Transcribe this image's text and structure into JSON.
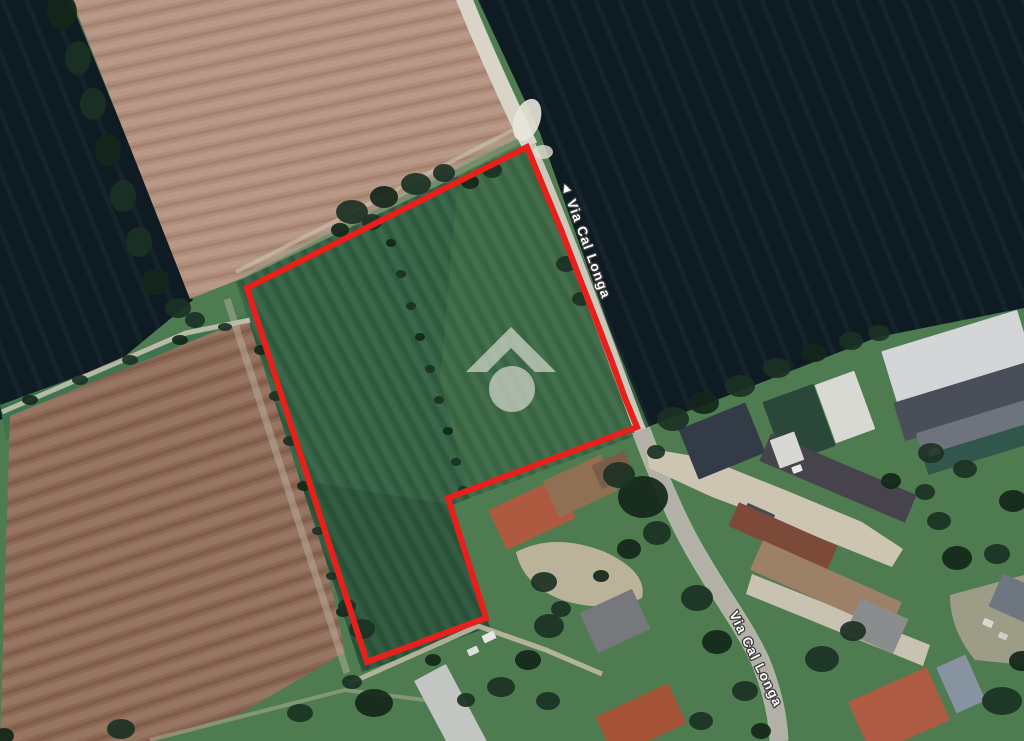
{
  "map": {
    "type": "satellite-view",
    "street_labels": [
      {
        "street": "Via Cal Longa",
        "display": "◄ Via Cal Longa",
        "rotation_deg": 70,
        "transform": "translate(560,183) rotate(70)"
      },
      {
        "street": "Via Cal Longa",
        "display": "Via Cal Longa",
        "rotation_deg": 64,
        "transform": "translate(729,614) rotate(64)"
      }
    ],
    "parcel_boundary": {
      "color": "#e8201c",
      "stroke_width": 6,
      "points": "527,147 543,186 562,232 578,274 596,320 612,362 625,398 637,427 448,498 486,618 367,662 247,288"
    },
    "watermark": {
      "name": "listing-portal-logo",
      "shape": "roof-chevron-over-circle",
      "color": "rgba(219,221,212,0.68)",
      "roof_points": "466,372 511,327 556,372 535,372 511,348 487,372",
      "circle": {
        "cx": 512,
        "cy": 389,
        "r": 23
      }
    },
    "palette": {
      "grass": "#4e7b50",
      "field_dark": "#0e1b22",
      "field_brown_top": "#b08d7a",
      "field_brown_bottom": "#8d6955",
      "parcel_green": "#315f41",
      "green_strip": "#3e7551",
      "road_gravel": "#d9d4c7",
      "road_asphalt": "#b3b0a8",
      "yard_concrete": "#cdc4b2",
      "dirt": "#c6b9a2",
      "label_fill": "#ffffff",
      "label_halo": "#3c3c3c"
    },
    "scene": {
      "tree_colors": [
        "#1b3124",
        "#142619"
      ],
      "trees": [
        [
          62,
          12,
          15,
          18
        ],
        [
          78,
          58,
          13,
          17
        ],
        [
          93,
          104,
          13,
          16
        ],
        [
          108,
          150,
          13,
          16
        ],
        [
          123,
          196,
          13,
          16
        ],
        [
          139,
          242,
          13,
          15
        ],
        [
          156,
          282,
          14,
          13
        ],
        [
          178,
          308,
          13,
          10
        ],
        [
          195,
          320,
          10,
          8
        ],
        [
          30,
          400,
          8,
          5
        ],
        [
          80,
          380,
          8,
          5
        ],
        [
          130,
          360,
          8,
          5
        ],
        [
          180,
          340,
          8,
          5
        ],
        [
          225,
          327,
          7,
          4
        ],
        [
          352,
          212,
          16,
          12
        ],
        [
          384,
          197,
          14,
          11
        ],
        [
          416,
          184,
          15,
          11
        ],
        [
          444,
          173,
          11,
          9
        ],
        [
          470,
          182,
          9,
          7
        ],
        [
          492,
          170,
          10,
          8
        ],
        [
          372,
          222,
          10,
          8
        ],
        [
          340,
          230,
          9,
          7
        ],
        [
          566,
          264,
          10,
          8
        ],
        [
          581,
          299,
          9,
          7
        ],
        [
          391,
          243,
          5,
          4
        ],
        [
          401,
          274,
          5,
          4
        ],
        [
          411,
          306,
          5,
          4
        ],
        [
          420,
          337,
          5,
          4
        ],
        [
          430,
          369,
          5,
          4
        ],
        [
          439,
          400,
          5,
          4
        ],
        [
          448,
          431,
          5,
          4
        ],
        [
          456,
          462,
          5,
          4
        ],
        [
          463,
          490,
          5,
          4
        ],
        [
          261,
          350,
          7,
          5
        ],
        [
          276,
          396,
          7,
          5
        ],
        [
          290,
          441,
          7,
          5
        ],
        [
          304,
          486,
          7,
          5
        ],
        [
          318,
          531,
          6,
          4
        ],
        [
          332,
          576,
          6,
          4
        ],
        [
          343,
          612,
          7,
          5
        ],
        [
          362,
          629,
          13,
          10
        ],
        [
          347,
          606,
          9,
          7
        ],
        [
          374,
          703,
          19,
          14
        ],
        [
          352,
          682,
          10,
          7
        ],
        [
          673,
          419,
          16,
          12
        ],
        [
          704,
          403,
          15,
          11
        ],
        [
          740,
          386,
          15,
          11
        ],
        [
          777,
          368,
          14,
          10
        ],
        [
          814,
          353,
          13,
          9
        ],
        [
          851,
          341,
          12,
          9
        ],
        [
          879,
          333,
          11,
          8
        ],
        [
          643,
          497,
          25,
          21
        ],
        [
          619,
          475,
          16,
          13
        ],
        [
          657,
          533,
          14,
          12
        ],
        [
          629,
          549,
          12,
          10
        ],
        [
          544,
          582,
          13,
          10
        ],
        [
          561,
          609,
          10,
          8
        ],
        [
          601,
          576,
          8,
          6
        ],
        [
          656,
          452,
          9,
          7
        ],
        [
          549,
          626,
          15,
          12
        ],
        [
          528,
          660,
          13,
          10
        ],
        [
          501,
          687,
          14,
          10
        ],
        [
          548,
          701,
          12,
          9
        ],
        [
          433,
          660,
          8,
          6
        ],
        [
          466,
          700,
          9,
          7
        ],
        [
          697,
          598,
          16,
          13
        ],
        [
          717,
          642,
          15,
          12
        ],
        [
          745,
          691,
          13,
          10
        ],
        [
          701,
          721,
          12,
          9
        ],
        [
          761,
          731,
          10,
          8
        ],
        [
          822,
          659,
          17,
          13
        ],
        [
          853,
          631,
          13,
          10
        ],
        [
          957,
          558,
          15,
          12
        ],
        [
          997,
          554,
          13,
          10
        ],
        [
          939,
          521,
          12,
          9
        ],
        [
          1013,
          501,
          14,
          11
        ],
        [
          931,
          453,
          13,
          10
        ],
        [
          965,
          469,
          12,
          9
        ],
        [
          891,
          481,
          10,
          8
        ],
        [
          925,
          492,
          10,
          8
        ],
        [
          1002,
          701,
          20,
          14
        ],
        [
          1022,
          661,
          13,
          10
        ],
        [
          121,
          729,
          14,
          10
        ],
        [
          300,
          713,
          13,
          9
        ],
        [
          4,
          736,
          10,
          8
        ]
      ],
      "buildings": [
        [
          "warehouse-roof",
          960,
          366,
          142,
          74,
          -17,
          "#d3d5d6"
        ],
        [
          "warehouse-roof-dark",
          971,
          400,
          150,
          40,
          -17,
          "#494e58"
        ],
        [
          "warehouse-roof-mid",
          981,
          427,
          128,
          26,
          -17,
          "#6e747d"
        ],
        [
          "greenhouse-teal",
          979,
          449,
          112,
          20,
          -17,
          "#31564b"
        ],
        [
          "quonset-shed",
          845,
          407,
          42,
          62,
          -20,
          "#d9d9d4"
        ],
        [
          "shed-green-roof",
          799,
          424,
          54,
          66,
          -20,
          "#2b473a"
        ],
        [
          "house-roof-navy",
          722,
          441,
          72,
          54,
          -22,
          "#333b47"
        ],
        [
          "barn-roof-dark-long",
          838,
          478,
          158,
          30,
          23,
          "#46434d"
        ],
        [
          "small-structure",
          757,
          519,
          30,
          22,
          24,
          "#3f4a52"
        ],
        [
          "barn-roof-rust",
          783,
          536,
          108,
          26,
          24,
          "#7d4a3a"
        ],
        [
          "building-tan-long",
          826,
          586,
          152,
          32,
          24,
          "#9d8166"
        ],
        [
          "house-roof-gray-small",
          877,
          626,
          52,
          38,
          24,
          "#8b8c8e"
        ],
        [
          "house-roof-terracotta",
          532,
          514,
          76,
          44,
          -25,
          "#ae5a40"
        ],
        [
          "building-roof-brown",
          580,
          486,
          64,
          40,
          -25,
          "#8f7053"
        ],
        [
          "building-roof-brown-ext",
          613,
          470,
          36,
          26,
          -25,
          "#7b5c47"
        ],
        [
          "house-roof-gray",
          615,
          621,
          58,
          44,
          -25,
          "#77787c"
        ],
        [
          "greenhouse-white",
          452,
          714,
          36,
          94,
          -28,
          "#c2c5c2"
        ],
        [
          "house-roof-red-south",
          641,
          720,
          80,
          44,
          -25,
          "#a55336"
        ],
        [
          "house-roof-red-east",
          899,
          711,
          86,
          58,
          -24,
          "#ad5c43"
        ],
        [
          "shed-roof-blue",
          961,
          684,
          32,
          50,
          -24,
          "#8793a0"
        ],
        [
          "building-roof-right-edge",
          1014,
          598,
          40,
          36,
          24,
          "#6e7680"
        ],
        [
          "white-boxes-row",
          787,
          450,
          26,
          30,
          -20,
          "#d8d8d2"
        ],
        [
          "vehicle",
          489,
          637,
          13,
          8,
          -25,
          "#e7e7e3"
        ],
        [
          "vehicle",
          473,
          651,
          11,
          7,
          -25,
          "#dedfdd"
        ],
        [
          "vehicle",
          934,
          452,
          12,
          7,
          -17,
          "#e3e3df"
        ],
        [
          "vehicle",
          797,
          469,
          10,
          7,
          -20,
          "#e8e8e4"
        ],
        [
          "vehicle",
          988,
          623,
          10,
          7,
          24,
          "#d9d7d0"
        ],
        [
          "vehicle",
          1003,
          636,
          9,
          6,
          24,
          "#cfcdc6"
        ]
      ]
    }
  }
}
